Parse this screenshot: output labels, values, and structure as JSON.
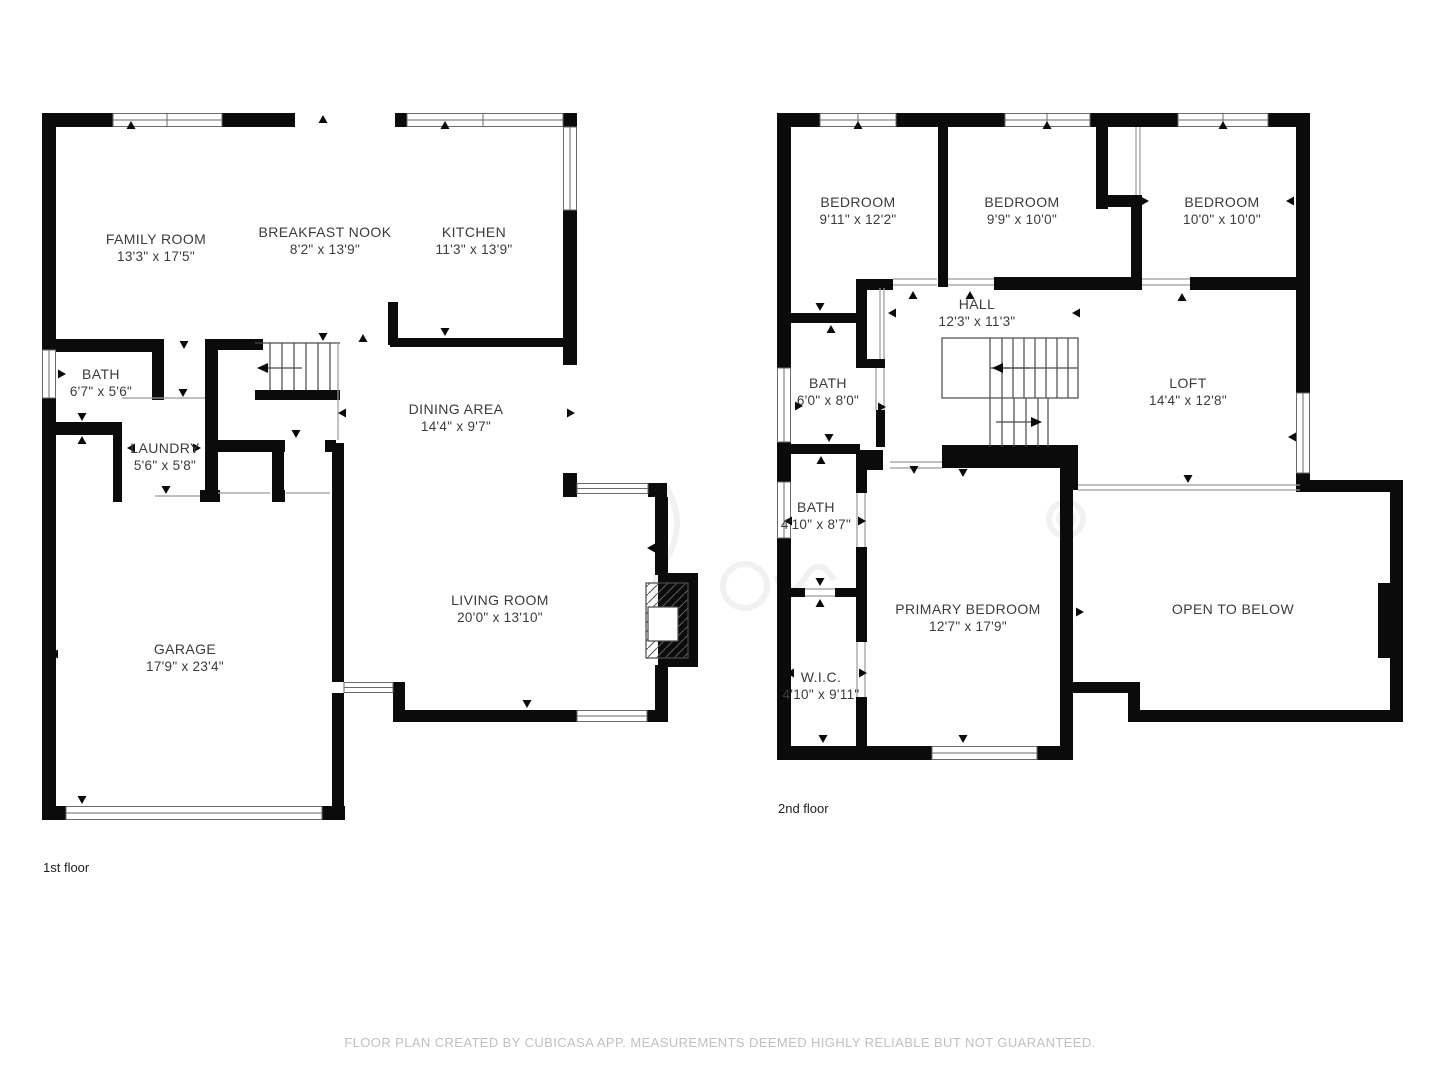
{
  "colors": {
    "wall": "#0b0b0b",
    "label_text": "#3b3b3b",
    "caption_text": "#c0c0c0",
    "background": "#ffffff"
  },
  "floor1": {
    "label": "1st floor",
    "rooms": [
      {
        "name": "FAMILY ROOM",
        "dims": "13'3\" x 17'5\""
      },
      {
        "name": "BREAKFAST NOOK",
        "dims": "8'2\" x 13'9\""
      },
      {
        "name": "KITCHEN",
        "dims": "11'3\" x 13'9\""
      },
      {
        "name": "BATH",
        "dims": "6'7\" x 5'6\""
      },
      {
        "name": "LAUNDRY",
        "dims": "5'6\" x 5'8\""
      },
      {
        "name": "DINING AREA",
        "dims": "14'4\" x 9'7\""
      },
      {
        "name": "LIVING ROOM",
        "dims": "20'0\" x 13'10\""
      },
      {
        "name": "GARAGE",
        "dims": "17'9\" x 23'4\""
      }
    ]
  },
  "floor2": {
    "label": "2nd floor",
    "rooms": [
      {
        "name": "BEDROOM",
        "dims": "9'11\" x 12'2\""
      },
      {
        "name": "BEDROOM",
        "dims": "9'9\" x 10'0\""
      },
      {
        "name": "BEDROOM",
        "dims": "10'0\" x 10'0\""
      },
      {
        "name": "HALL",
        "dims": "12'3\" x 11'3\""
      },
      {
        "name": "BATH",
        "dims": "6'0\" x 8'0\""
      },
      {
        "name": "LOFT",
        "dims": "14'4\" x 12'8\""
      },
      {
        "name": "BATH",
        "dims": "4'10\" x 8'7\""
      },
      {
        "name": "PRIMARY BEDROOM",
        "dims": "12'7\" x 17'9\""
      },
      {
        "name": "W.I.C.",
        "dims": "4'10\" x 9'11\""
      },
      {
        "name": "OPEN TO BELOW",
        "dims": ""
      }
    ]
  },
  "footer": {
    "caption": "FLOOR PLAN CREATED BY CUBICASA APP. MEASUREMENTS DEEMED HIGHLY RELIABLE BUT NOT GUARANTEED."
  }
}
